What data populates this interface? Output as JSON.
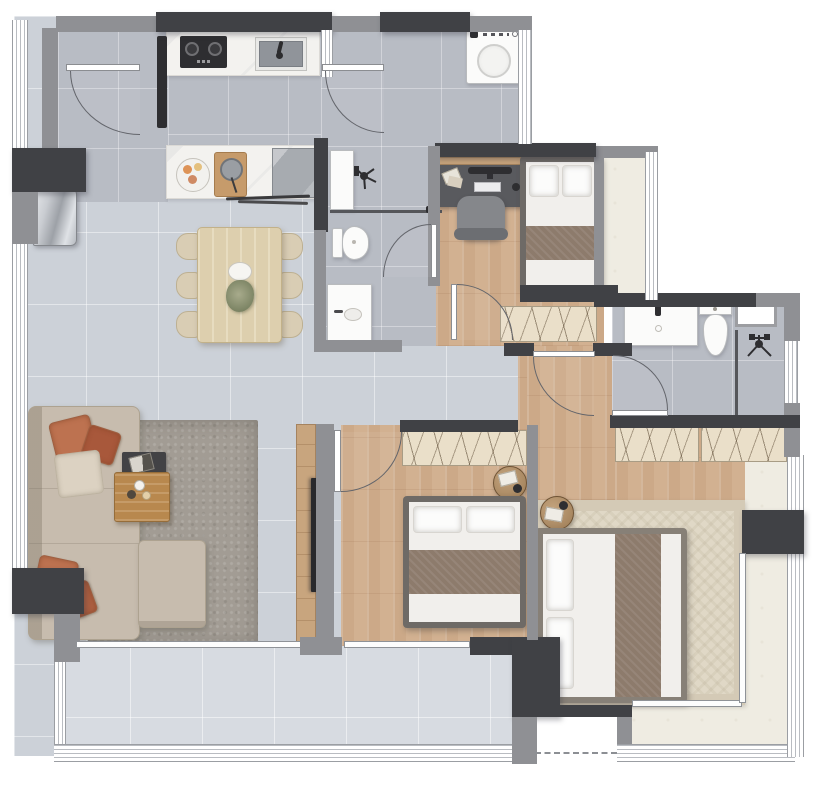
{
  "title": "apartment-floor-plan",
  "colors": {
    "wall-dark": "#404145",
    "wall-mid": "#8f9094",
    "tile-light": "#ccd1d8",
    "tile-mid": "#b8bcc4",
    "tile-balcony": "#d7dbe1",
    "wood": "#d2b191",
    "stone-cream": "#efece2",
    "counter": "#f3f2ef",
    "wardrobe": "#eadfc9",
    "sofa": "#c7bcae",
    "pillow-terracotta": "#bd7250",
    "pillow-cream": "#dcd2c2",
    "rug-gray": "#a29c94",
    "rug-master": "#e0d8c6",
    "rug-master-border": "#d4cab6",
    "blanket": "#8d7b6c",
    "bed-frame": "#6e6a66",
    "master-bed-frame": "#878077",
    "desk": "#595a5e",
    "dining-table": "#ddcfae",
    "chair": "#d9cdb4",
    "appliance": "#a7abb0",
    "plant": "#8e9678",
    "coffee-table": "#b8884e",
    "tv-panel": "#c8a57e",
    "glass-line": "#55565a"
  },
  "rooms": [
    {
      "name": "entry-foyer",
      "floor": "tile-mid"
    },
    {
      "name": "kitchen",
      "floor": "tile-mid"
    },
    {
      "name": "living-dining",
      "floor": "tile-light"
    },
    {
      "name": "laundry-area",
      "floor": "tile-mid"
    },
    {
      "name": "bathroom-1",
      "floor": "tile-mid"
    },
    {
      "name": "bedroom-1",
      "floor": "wood"
    },
    {
      "name": "balcony-1",
      "floor": "stone-cream"
    },
    {
      "name": "bathroom-2",
      "floor": "tile-mid"
    },
    {
      "name": "hallway",
      "floor": "tile-light"
    },
    {
      "name": "bedroom-2",
      "floor": "wood"
    },
    {
      "name": "master-bedroom",
      "floor": "wood"
    },
    {
      "name": "living-balcony",
      "floor": "tile-balcony"
    },
    {
      "name": "master-balcony",
      "floor": "stone-cream"
    }
  ],
  "furniture": [
    "entry-door",
    "refrigerator",
    "kitchen-counter-top",
    "cooktop",
    "kitchen-sink",
    "kitchen-counter-bottom",
    "fruit-plate",
    "cutting-board",
    "dishwasher",
    "utensils",
    "dining-table",
    "dining-chairs-x6",
    "centerpiece-plant",
    "washing-machine",
    "sofa-l-shaped",
    "throw-pillows",
    "gray-rug",
    "side-tray-table",
    "coffee-table",
    "tv-panel",
    "wall-tv",
    "shower-1",
    "toilet-1",
    "vanity-1",
    "glass-partition-1",
    "desk",
    "office-chair",
    "monitor",
    "keyboard",
    "bed-1",
    "wardrobe-1",
    "vanity-2",
    "toilet-2",
    "shower-2",
    "glass-partition-2",
    "bathroom-window",
    "wardrobe-master-a",
    "wardrobe-master-b",
    "round-side-table-1",
    "round-side-table-2",
    "master-bed",
    "master-rug",
    "bed-2",
    "wardrobe-2",
    "sliding-doors",
    "windows"
  ]
}
